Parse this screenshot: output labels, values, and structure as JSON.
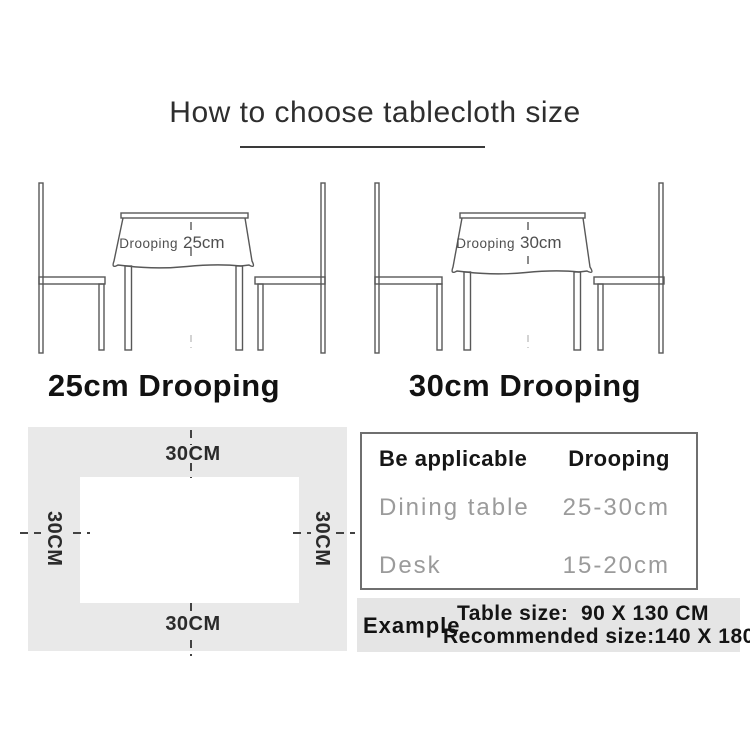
{
  "title": "How to choose tablecloth size",
  "illustrations": [
    {
      "drooping_label": "Drooping",
      "drooping_value": "25cm",
      "caption": "25cm Drooping"
    },
    {
      "drooping_label": "Drooping",
      "drooping_value": "30cm",
      "caption": "30cm Drooping"
    }
  ],
  "size_diagram": {
    "top": "30CM",
    "bottom": "30CM",
    "left": "30CM",
    "right": "30CM"
  },
  "guide_table": {
    "headers": {
      "col1": "Be applicable",
      "col2": "Drooping"
    },
    "rows": [
      {
        "use": "Dining table",
        "drooping": "25-30cm"
      },
      {
        "use": "Desk",
        "drooping": "15-20cm"
      }
    ]
  },
  "example": {
    "label": "Example",
    "line1": "Table size:  90 X 130 CM",
    "line2": "Recommended size:140 X 180 CM"
  },
  "colors": {
    "line_gray": "#585858",
    "panel_gray": "#e9e9e9",
    "strip_gray": "#e5e5e5",
    "text_dark": "#161616",
    "text_gray": "#9b9b9b"
  }
}
